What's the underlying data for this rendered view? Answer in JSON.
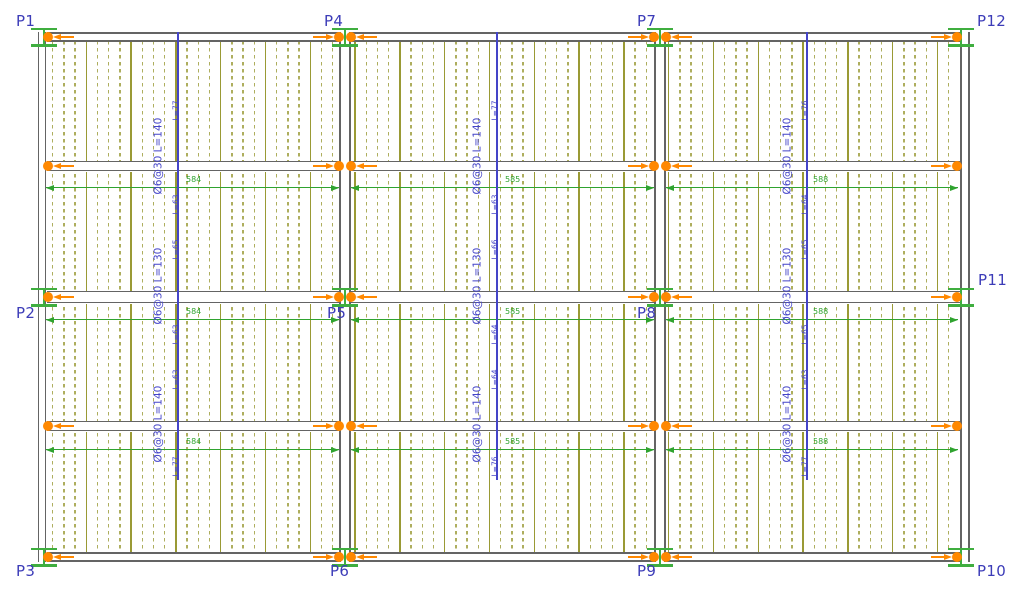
{
  "drawing": {
    "type": "structural-floor-plan",
    "canvas": {
      "width": 1024,
      "height": 597,
      "background": "#ffffff"
    },
    "colors": {
      "column_label": "#3c3cb8",
      "annotation_blue": "#4444c8",
      "dim_green": "#2fa32f",
      "column_green": "#3fae3f",
      "column_orange": "#ff8800",
      "beam_gray": "#646464",
      "joist_solid": "#9a9a35",
      "joist_dashed": "#aeae5e"
    },
    "beams": {
      "horizontal": [
        {
          "y": 37,
          "x1": 38,
          "x2": 968,
          "t": 10
        },
        {
          "y": 166,
          "x1": 38,
          "x2": 968,
          "t": 11
        },
        {
          "y": 297,
          "x1": 38,
          "x2": 968,
          "t": 13
        },
        {
          "y": 426,
          "x1": 38,
          "x2": 968,
          "t": 11
        },
        {
          "y": 557,
          "x1": 38,
          "x2": 968,
          "t": 10
        }
      ],
      "vertical": [
        {
          "x": 42,
          "y1": 32,
          "y2": 562,
          "t": 9
        },
        {
          "x": 345,
          "y1": 32,
          "y2": 562,
          "t": 12
        },
        {
          "x": 660,
          "y1": 32,
          "y2": 562,
          "t": 12
        },
        {
          "x": 965,
          "y1": 32,
          "y2": 562,
          "t": 10
        }
      ]
    },
    "joists": {
      "x_start": 52,
      "x_end": 956,
      "spacing": 11.2,
      "solid_every": 4,
      "y1": 34,
      "y2": 560
    },
    "columns": [
      {
        "label": "P1",
        "x": 44,
        "y": 37,
        "marker": "single-right",
        "label_x": 16,
        "label_y": 14
      },
      {
        "label": "P4",
        "x": 345,
        "y": 37,
        "marker": "double",
        "label_x": 324,
        "label_y": 14
      },
      {
        "label": "P7",
        "x": 660,
        "y": 37,
        "marker": "double",
        "label_x": 637,
        "label_y": 14
      },
      {
        "label": "P12",
        "x": 961,
        "y": 37,
        "marker": "single-left",
        "label_x": 977,
        "label_y": 14
      },
      {
        "label": "P2",
        "x": 44,
        "y": 297,
        "marker": "single-right",
        "label_x": 16,
        "label_y": 306
      },
      {
        "label": "P5",
        "x": 345,
        "y": 297,
        "marker": "double",
        "label_x": 327,
        "label_y": 306
      },
      {
        "label": "P8",
        "x": 660,
        "y": 297,
        "marker": "double",
        "label_x": 637,
        "label_y": 306
      },
      {
        "label": "P11",
        "x": 961,
        "y": 297,
        "marker": "single-left",
        "label_x": 978,
        "label_y": 273
      },
      {
        "label": "P3",
        "x": 44,
        "y": 557,
        "marker": "single-right",
        "label_x": 16,
        "label_y": 564
      },
      {
        "label": "P6",
        "x": 345,
        "y": 557,
        "marker": "double",
        "label_x": 330,
        "label_y": 564
      },
      {
        "label": "P9",
        "x": 660,
        "y": 557,
        "marker": "double",
        "label_x": 637,
        "label_y": 564
      },
      {
        "label": "P10",
        "x": 961,
        "y": 557,
        "marker": "single-left",
        "label_x": 977,
        "label_y": 564
      }
    ],
    "intermediate_supports": [
      {
        "x": 44,
        "y": 166,
        "marker": "single-right"
      },
      {
        "x": 345,
        "y": 166,
        "marker": "double"
      },
      {
        "x": 660,
        "y": 166,
        "marker": "double"
      },
      {
        "x": 961,
        "y": 166,
        "marker": "single-left"
      },
      {
        "x": 44,
        "y": 426,
        "marker": "single-right"
      },
      {
        "x": 345,
        "y": 426,
        "marker": "double"
      },
      {
        "x": 660,
        "y": 426,
        "marker": "double"
      },
      {
        "x": 961,
        "y": 426,
        "marker": "single-left"
      }
    ],
    "annotation_lines": [
      {
        "x": 178,
        "y_top": 32,
        "y_bottom": 480,
        "blocks": [
          {
            "text": "Ø6@30 L=140",
            "y_bottom": 196
          },
          {
            "text": "Ø6@30 L=130",
            "y_bottom": 326
          },
          {
            "text": "Ø6@30 L=140",
            "y_bottom": 464
          }
        ],
        "tags": [
          {
            "text": "L=77",
            "y_bottom": 122
          },
          {
            "text": "L=63",
            "y_bottom": 216
          },
          {
            "text": "L=65",
            "y_bottom": 261
          },
          {
            "text": "L=63",
            "y_bottom": 346
          },
          {
            "text": "L=63",
            "y_bottom": 391
          },
          {
            "text": "L=77",
            "y_bottom": 478
          }
        ]
      },
      {
        "x": 497,
        "y_top": 32,
        "y_bottom": 480,
        "blocks": [
          {
            "text": "Ø6@30 L=140",
            "y_bottom": 196
          },
          {
            "text": "Ø6@30 L=130",
            "y_bottom": 326
          },
          {
            "text": "Ø6@30 L=140",
            "y_bottom": 464
          }
        ],
        "tags": [
          {
            "text": "L=77",
            "y_bottom": 122
          },
          {
            "text": "L=63",
            "y_bottom": 216
          },
          {
            "text": "L=66",
            "y_bottom": 261
          },
          {
            "text": "L=64",
            "y_bottom": 346
          },
          {
            "text": "L=64",
            "y_bottom": 391
          },
          {
            "text": "L=76",
            "y_bottom": 478
          }
        ]
      },
      {
        "x": 807,
        "y_top": 32,
        "y_bottom": 480,
        "blocks": [
          {
            "text": "Ø6@30 L=140",
            "y_bottom": 196
          },
          {
            "text": "Ø6@30 L=130",
            "y_bottom": 326
          },
          {
            "text": "Ø6@30 L=140",
            "y_bottom": 464
          }
        ],
        "tags": [
          {
            "text": "L=76",
            "y_bottom": 122
          },
          {
            "text": "L=64",
            "y_bottom": 216
          },
          {
            "text": "L=65",
            "y_bottom": 261
          },
          {
            "text": "L=65",
            "y_bottom": 346
          },
          {
            "text": "L=63",
            "y_bottom": 391
          },
          {
            "text": "L=77",
            "y_bottom": 478
          }
        ]
      }
    ],
    "dimensions": {
      "rows_y": [
        188,
        320,
        450
      ],
      "spans": [
        {
          "x1": 46,
          "x2": 339,
          "label": "584",
          "label_x": 186
        },
        {
          "x1": 351,
          "x2": 654,
          "label": "585",
          "label_x": 505
        },
        {
          "x1": 666,
          "x2": 958,
          "label": "588",
          "label_x": 813
        }
      ]
    }
  }
}
